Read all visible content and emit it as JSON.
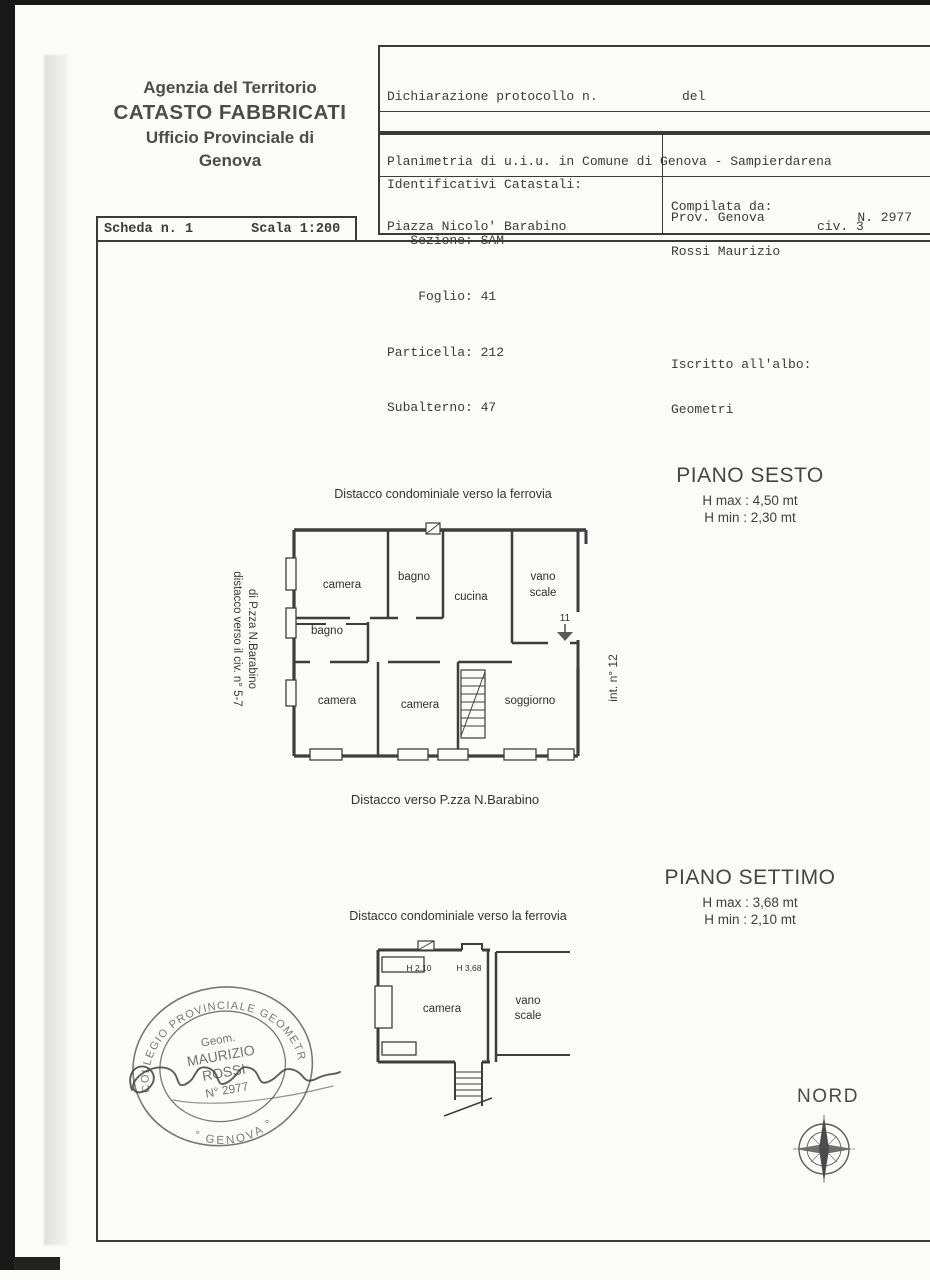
{
  "header": {
    "agency_line1": "Agenzia del Territorio",
    "agency_line2": "CATASTO FABBRICATI",
    "agency_line3": "Ufficio Provinciale di",
    "agency_line4": "Genova",
    "scheda": "Scheda n. 1",
    "scala": "Scala 1:200",
    "protocol_row1_label": "Dichiarazione protocollo n.",
    "protocol_row1_del": "del",
    "protocol_row2": "Planimetria di u.i.u. in Comune di Genova - Sampierdarena",
    "protocol_row3_street": "Piazza Nicolo' Barabino",
    "protocol_row3_civ": "civ. 3",
    "id_line1": "Identificativi Catastali:",
    "id_line2": "   Sezione: SAM",
    "id_line3": "    Foglio: 41",
    "id_line4": "Particella: 212",
    "id_line5": "Subalterno: 47",
    "comp_label": "Compilata da:",
    "comp_name": "Rossi Maurizio",
    "albo_label": "Iscritto all'albo:",
    "albo_value": "Geometri",
    "prov": "Prov. Genova",
    "reg_number": "N. 2977"
  },
  "floor6": {
    "title": "PIANO SESTO",
    "h_max": "H max : 4,50 mt",
    "h_min": "H min : 2,30 mt",
    "label_top": "Distacco condominiale verso la ferrovia",
    "label_bottom": "Distacco verso P.zza N.Barabino",
    "label_left_line1": "distacco verso il civ. n° 5-7",
    "label_left_line2": "di P.zza N.Barabino",
    "label_right": "int. n° 12",
    "door_number": "11",
    "rooms": {
      "camera_top": "camera",
      "bagno_top": "bagno",
      "cucina": "cucina",
      "vano": "vano",
      "scale": "scale",
      "bagno_mid": "bagno",
      "camera_bottom_left": "camera",
      "camera_bottom_mid": "camera",
      "soggiorno": "soggiorno"
    }
  },
  "floor7": {
    "title": "PIANO SETTIMO",
    "h_max": "H max : 3,68 mt",
    "h_min": "H min : 2,10 mt",
    "label_top": "Distacco condominiale verso la ferrovia",
    "h_label_1": "H 2,10",
    "h_label_2": "H 3,68",
    "rooms": {
      "camera": "camera",
      "vano": "vano",
      "scale": "scale"
    }
  },
  "stamp": {
    "ring_top": "COLLEGIO PROVINCIALE GEOMETRI",
    "ring_bottom": "° GENOVA °",
    "center_line1": "Geom.",
    "center_line2": "MAURIZIO",
    "center_line3": "ROSSI",
    "center_line4": "N° 2977"
  },
  "compass": {
    "label": "NORD"
  }
}
